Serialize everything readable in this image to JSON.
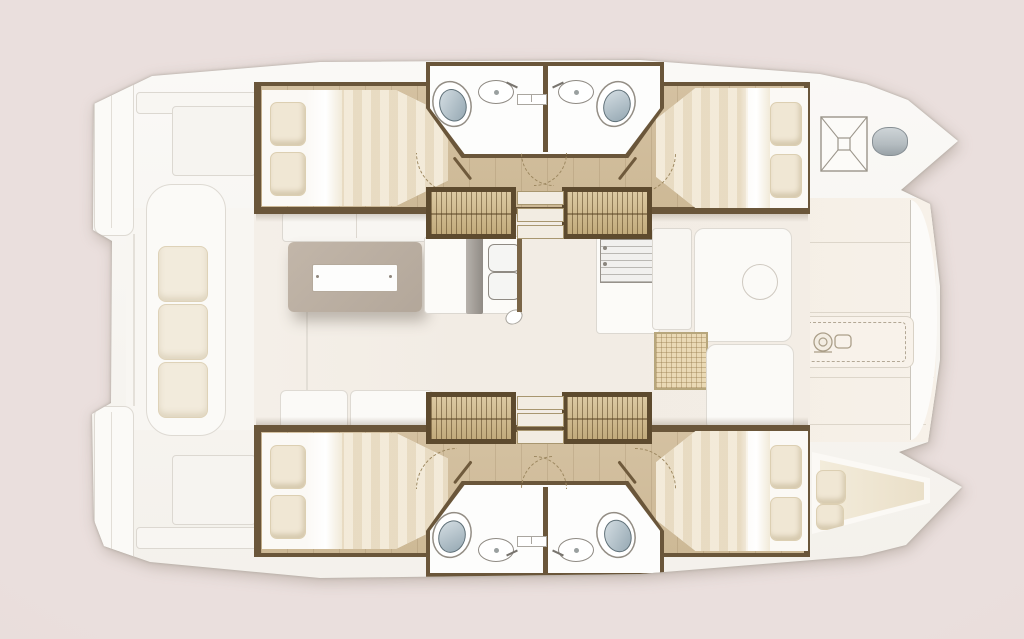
{
  "meta": {
    "title": "Catamaran accommodation and deck floor plan",
    "diagram_type": "yacht-floorplan-top-view",
    "orientation": "bow-right-stern-left",
    "visible_text": "none"
  },
  "palette": {
    "background": "#eadfdd",
    "deck": "#fbfaf8",
    "deck_line": "#aba59c",
    "wood": "#cdb996",
    "wood_dark": "#6a563a",
    "stair": "#c2ab7c",
    "tread": "#f2ece2",
    "mattress": "#fbf9f5",
    "stripe": "#e6d8bd",
    "pillow": "#f0e7d4",
    "cushion": "#f2ebdc",
    "bowl": "#93a6b1",
    "line": "#8f8a83",
    "table": "#b3a79a",
    "foredeck": "#f7f1e9",
    "mesh": "#ead9b5",
    "floor": "#f2ece4",
    "steel": "#b4bcc0"
  },
  "vessel": {
    "type": "sailing catamaran, two hulls with central bridgedeck",
    "upper_hull": {
      "aft_cabin": {
        "berth": "double bed",
        "pillows": 2,
        "floor": "wood"
      },
      "heads": [
        {
          "fixtures": [
            "toilet",
            "washbasin with faucet"
          ],
          "door": "swing shown dashed"
        },
        {
          "fixtures": [
            "toilet",
            "washbasin with faucet"
          ],
          "door": "swing shown dashed"
        }
      ],
      "forward_cabin": {
        "berth": "double bed",
        "pillows": 2,
        "floor": "wood"
      },
      "forepeak": {
        "features": [
          "square deck hatch with X bracing",
          "oval deck cover"
        ]
      }
    },
    "lower_hull": {
      "aft_cabin": {
        "berth": "double bed",
        "pillows": 2,
        "floor": "wood"
      },
      "heads": [
        {
          "fixtures": [
            "toilet",
            "washbasin with faucet"
          ],
          "door": "swing shown dashed"
        },
        {
          "fixtures": [
            "toilet",
            "washbasin with faucet"
          ],
          "door": "swing shown dashed"
        }
      ],
      "forward_cabin": {
        "berth": "double bed",
        "pillows": 2,
        "floor": "wood"
      },
      "forepeak": {
        "features": [
          "single bow berth with cushion",
          "pillows"
        ],
        "pillows": 2
      }
    },
    "bridgedeck": {
      "aft_cockpit": {
        "items": [
          "bench seat",
          "3 seat cushions",
          "transom platforms port and starboard",
          "deck panels"
        ]
      },
      "saloon": {
        "items": [
          "dining table with white centerline insert",
          "aft cabinet",
          "bench sofas"
        ]
      },
      "galley": {
        "items": [
          "double sink",
          "mixer tap",
          "mast post",
          "stove top",
          "counters"
        ]
      },
      "forward_lounge": {
        "items": [
          "lounge seats",
          "round deck-hatch outline",
          "woven mat panel"
        ]
      },
      "foredeck": {
        "items": [
          "paneled solid foredeck",
          "recessed locker panel",
          "optional windlass shown dashed"
        ]
      },
      "companionways": {
        "slatted_step_units": 4,
        "central_step_flights": 2,
        "treads_per_flight": 3
      }
    }
  },
  "icons": [
    {
      "name": "windlass-icon",
      "meaning": "anchor windlass (optional, dashed outline)"
    },
    {
      "name": "deck-hatch-icon",
      "meaning": "square forepeak hatch with X bracing"
    },
    {
      "name": "deck-cover-icon",
      "meaning": "oval deck cover / hatch"
    },
    {
      "name": "toilet",
      "meaning": "marine toilet"
    },
    {
      "name": "washbasin",
      "meaning": "oval washbasin with faucet"
    }
  ],
  "counts": {
    "cabins": 4,
    "heads": 4,
    "bow_berth": 1,
    "toilets": 4,
    "washbasins": 4
  }
}
